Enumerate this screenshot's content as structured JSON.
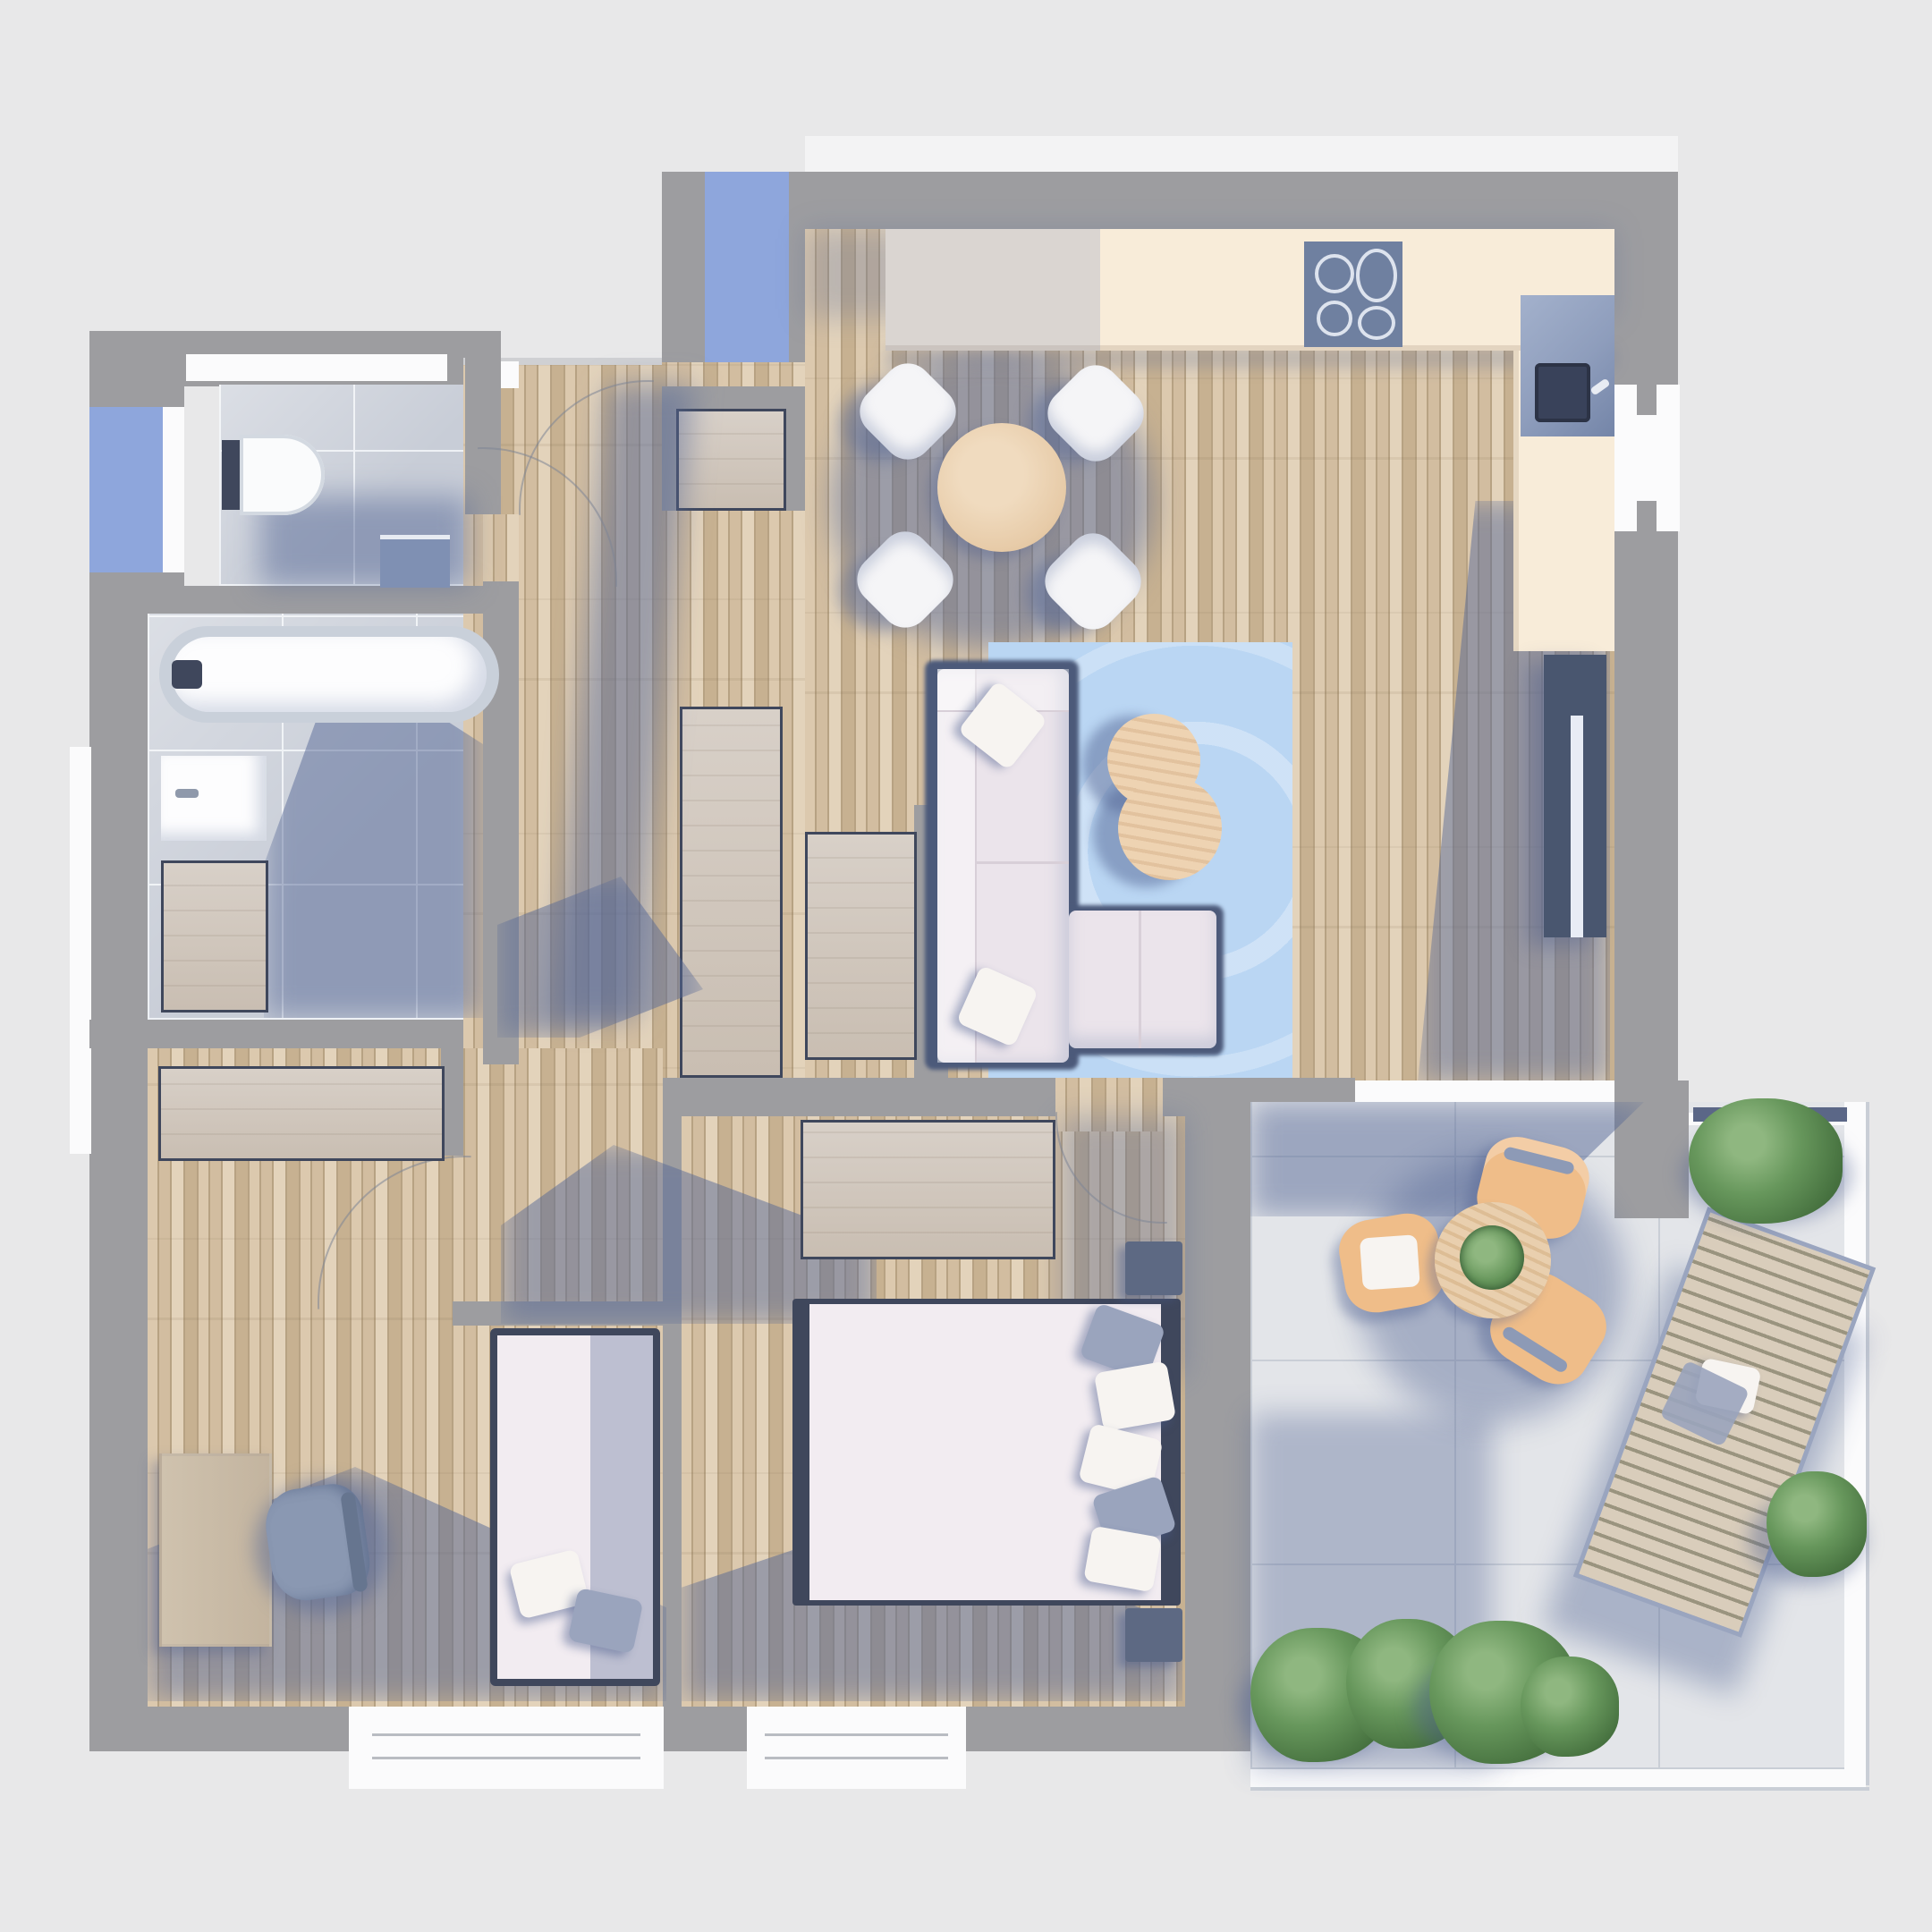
{
  "scene": {
    "type": "3d-rendered-floor-plan-top-view",
    "subject": "apartment floor plan with open living-kitchen, hallway, bathroom, wc, two bedrooms and a roof terrace",
    "text_content": "none — the image contains no visible text, numbers or labels"
  },
  "colors": {
    "bg": "#e8e8e9",
    "wall": "#9d9da0",
    "framedark": "#3f475c",
    "white": "#fbfbfc",
    "wood1": "#dcc9ae",
    "wood2": "#d2bda0",
    "wood3": "#e3d3bb",
    "wood4": "#c7b191",
    "woodline": "#b7a283",
    "plain1": "#d8d0c8",
    "plain2": "#c9beb2",
    "tile": "#c8cdd7",
    "tileline": "#eef1f5",
    "terrace": "#e3e5e9",
    "terrline": "#c9ced6",
    "counter": "#f8ecd9",
    "cooktop": "#6f80a0",
    "ring": "#dde3ee",
    "sinkunit": "#8e9dbc",
    "sinkdark": "#39425a",
    "bluewindow": "#8ea6dc",
    "rug": "#bad6f3",
    "sofa": "#ebe4eb",
    "sofabase": "#4c5a7a",
    "pillowwhite": "#f7f4f1",
    "pillowgray": "#9aa4bd",
    "coffeetable": "#eed3b2",
    "diningtable": "#e7cba8",
    "chairwhite": "#f5f5f7",
    "sideboard": "#49566f",
    "lamp": "#e8ecf5",
    "duvet": "#f2ecf1",
    "nightstand": "#5d6983",
    "deskwood": "#cfc2ae",
    "chairgray": "#8a98b2",
    "terrchair": "#efbd89",
    "terrtable": "#e9cfae",
    "lounger": "#d9cdbb",
    "loungerslat": "#9a947f",
    "bush": "#67975c",
    "bushdark": "#46713f",
    "bushlight": "#8fb780",
    "shadow": "rgba(86,103,150,0.5)"
  },
  "rooms": [
    {
      "id": "wc",
      "floor": "ceramic-tile",
      "features": [
        "toilet",
        "blue-cabinet",
        "top-window"
      ]
    },
    {
      "id": "bathroom",
      "floor": "ceramic-tile",
      "features": [
        "bathtub",
        "washbasin",
        "wood-cabinet"
      ]
    },
    {
      "id": "entry-hall",
      "floor": "wood-plank",
      "features": [
        "blue-entrance-mat",
        "storage-closet",
        "wardrobe",
        "door-arcs"
      ]
    },
    {
      "id": "living-kitchen",
      "floor": "wood-plank",
      "features": [
        "kitchen-counter",
        "cooktop",
        "sink",
        "dining-table",
        "four-chairs",
        "blue-rug",
        "corner-sofa",
        "coffee-table",
        "sideboard",
        "right-window",
        "terrace-door"
      ]
    },
    {
      "id": "small-bedroom-office",
      "floor": "wood-plank",
      "features": [
        "sideboard",
        "desk",
        "office-chair",
        "single-bed",
        "bottom-window"
      ]
    },
    {
      "id": "main-bedroom",
      "floor": "wood-plank",
      "features": [
        "wardrobe",
        "double-bed",
        "two-nightstands",
        "pillows",
        "bottom-window"
      ]
    },
    {
      "id": "terrace",
      "floor": "stone-tile",
      "features": [
        "round-table",
        "three-wood-chairs",
        "plant",
        "sun-lounger",
        "bushes",
        "railing"
      ]
    }
  ]
}
